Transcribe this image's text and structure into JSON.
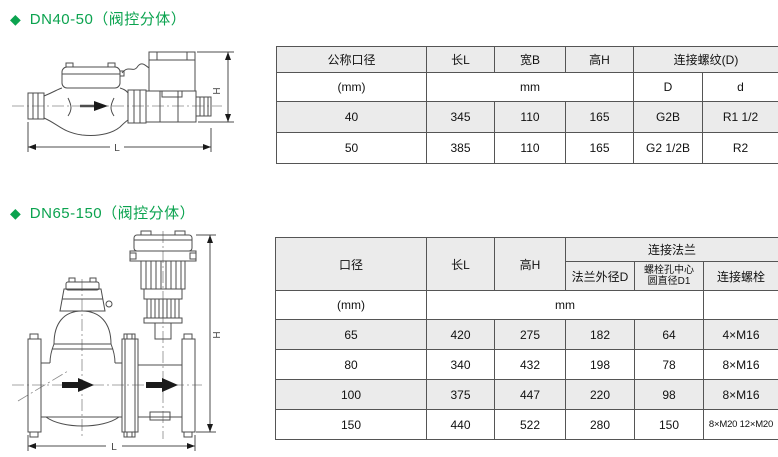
{
  "page": {
    "accent_green": "#0ba34f",
    "table_header_bg": "#ebebeb"
  },
  "section1": {
    "bullet": "◆",
    "heading": "DN40-50（阀控分体）",
    "drawing": {
      "dim_length": "L",
      "dim_height": "H"
    },
    "table": {
      "col_diameter": "公称口径",
      "col_length": "长L",
      "col_width": "宽B",
      "col_height": "高H",
      "col_thread": "连接螺纹(D)",
      "unit_diameter": "(mm)",
      "unit_mm": "mm",
      "sub_D": "D",
      "sub_d": "d",
      "rows": [
        [
          "40",
          "345",
          "110",
          "165",
          "G2B",
          "R1 1/2"
        ],
        [
          "50",
          "385",
          "110",
          "165",
          "G2 1/2B",
          "R2"
        ]
      ]
    }
  },
  "section2": {
    "bullet": "◆",
    "heading": "DN65-150（阀控分体）",
    "drawing": {
      "dim_length": "L",
      "dim_height": "H"
    },
    "table": {
      "col_diameter": "口径",
      "col_length": "长L",
      "col_height": "高H",
      "col_flange": "连接法兰",
      "sub_flange_od": "法兰外径D",
      "sub_bolt_circle_l1": "螺栓孔中心",
      "sub_bolt_circle_l2": "圆直径D1",
      "sub_bolt": "连接螺栓",
      "unit_diameter": "(mm)",
      "unit_mm": "mm",
      "rows": [
        [
          "65",
          "420",
          "275",
          "182",
          "64",
          "4×M16"
        ],
        [
          "80",
          "340",
          "432",
          "198",
          "78",
          "8×M16"
        ],
        [
          "100",
          "375",
          "447",
          "220",
          "98",
          "8×M16"
        ],
        [
          "150",
          "440",
          "522",
          "280",
          "150",
          "8×M20 12×M20"
        ]
      ]
    }
  }
}
